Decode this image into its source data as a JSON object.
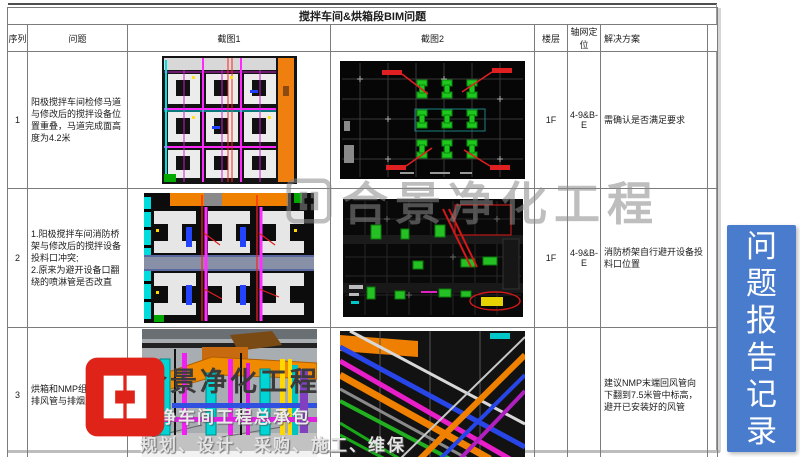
{
  "document": {
    "title": "搅拌车间&烘箱段BIM问题",
    "columns": {
      "seq": "序列",
      "problem": "问题",
      "screenshot1": "截图1",
      "screenshot2": "截图2",
      "floor": "楼层",
      "axis": "轴网定位",
      "solution": "解决方案"
    },
    "rows": [
      {
        "seq": "1",
        "problem": "阳极搅拌车间检修马道与修改后的搅拌设备位置重叠，马道完成面高度为4.2米",
        "floor": "1F",
        "axis": "4-9&B-E",
        "solution": "需确认是否满足要求"
      },
      {
        "seq": "2",
        "problem": "1.阳极搅拌车间消防桥架与修改后的搅拌设备投料口冲突;\n2.原来为避开设备口翻绕的喷淋管是否改直",
        "floor": "1F",
        "axis": "4-9&B-E",
        "solution": "消防桥架自行避开设备投料口位置"
      },
      {
        "seq": "3",
        "problem": "烘箱和NMP组合机尾气排风管与排烟风管冲突",
        "floor": "",
        "axis": "",
        "solution": "建议NMP末端回风管向下翻到7.5米管中标高，避开已安装好的风管"
      }
    ]
  },
  "sidebar_tab": {
    "label": "问题报告记录",
    "color": "#4a7ccd"
  },
  "watermark": {
    "brand_center": "合景净化工程",
    "brand_large": "合景净化工程",
    "tagline1": "洁净车间工程总承包",
    "tagline2": "规划、设计、采购、施工、维保",
    "logo_color": "#e02318"
  }
}
